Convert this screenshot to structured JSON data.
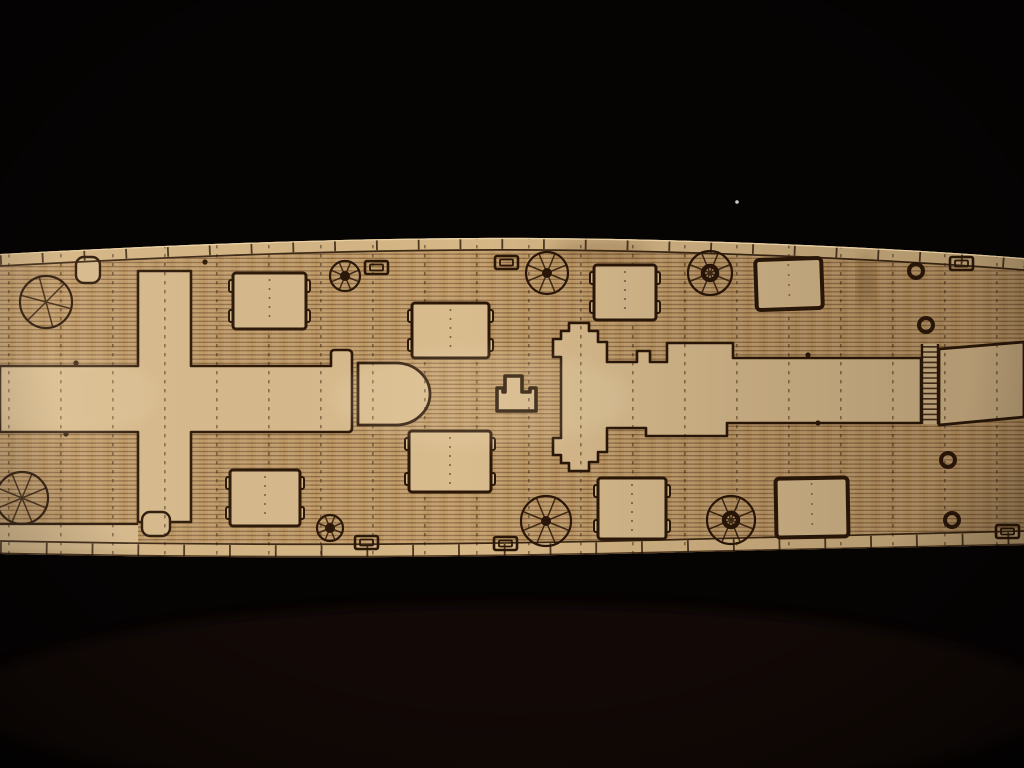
{
  "meta": {
    "description": "Photograph of a laser-etched wooden model ship deck strip lying diagonally across a black background, engraved with plank lines, hatches, capstan rosettes, rings and cleats"
  },
  "palette": {
    "bg": "#060303",
    "bg_glow": "#2c1410",
    "wood_planked": "#c49e6a",
    "wood_smooth": "#d9bc8e",
    "wood_margin": "#d6b786",
    "plank_line": "#5a3a1c",
    "outline": "#2a1708",
    "edge_highlight": "#eed7a8",
    "speck": "#e8e2d8"
  },
  "deck": {
    "hatches": [
      {
        "x": 233,
        "y": 273,
        "w": 73,
        "h": 56,
        "style": "notched",
        "tilt": 0
      },
      {
        "x": 412,
        "y": 303,
        "w": 77,
        "h": 55,
        "style": "notched",
        "tilt": 0
      },
      {
        "x": 409,
        "y": 431,
        "w": 82,
        "h": 61,
        "style": "notched",
        "tilt": 0
      },
      {
        "x": 230,
        "y": 470,
        "w": 70,
        "h": 56,
        "style": "notched",
        "tilt": 0
      },
      {
        "x": 594,
        "y": 265,
        "w": 62,
        "h": 55,
        "style": "notched",
        "tilt": 0
      },
      {
        "x": 598,
        "y": 478,
        "w": 68,
        "h": 61,
        "style": "notched",
        "tilt": 0
      },
      {
        "x": 756,
        "y": 259,
        "w": 66,
        "h": 50,
        "style": "plain",
        "tilt": -2
      },
      {
        "x": 776,
        "y": 478,
        "w": 72,
        "h": 59,
        "style": "plain",
        "tilt": -1
      }
    ],
    "rosettes": [
      {
        "cx": 46,
        "cy": 302,
        "r": 26,
        "spokes": 6,
        "hub": "none"
      },
      {
        "cx": 22,
        "cy": 498,
        "r": 26,
        "spokes": 8,
        "hub": "none"
      },
      {
        "cx": 345,
        "cy": 276,
        "r": 15,
        "spokes": 8,
        "hub": "dot"
      },
      {
        "cx": 547,
        "cy": 273,
        "r": 21,
        "spokes": 8,
        "hub": "dot"
      },
      {
        "cx": 710,
        "cy": 273,
        "r": 22,
        "spokes": 8,
        "hub": "ring"
      },
      {
        "cx": 330,
        "cy": 528,
        "r": 13,
        "spokes": 8,
        "hub": "dot"
      },
      {
        "cx": 546,
        "cy": 521,
        "r": 25,
        "spokes": 8,
        "hub": "dot"
      },
      {
        "cx": 731,
        "cy": 520,
        "r": 24,
        "spokes": 8,
        "hub": "ring"
      }
    ],
    "rings": [
      {
        "cx": 916,
        "cy": 271,
        "r": 7
      },
      {
        "cx": 926,
        "cy": 325,
        "r": 7
      },
      {
        "cx": 948,
        "cy": 460,
        "r": 7
      },
      {
        "cx": 952,
        "cy": 520,
        "r": 7
      }
    ],
    "cleats": [
      {
        "x": 365,
        "y": 261
      },
      {
        "x": 495,
        "y": 256
      },
      {
        "x": 950,
        "y": 257
      },
      {
        "x": 355,
        "y": 536
      },
      {
        "x": 494,
        "y": 537
      },
      {
        "x": 996,
        "y": 525
      }
    ],
    "dots": [
      {
        "cx": 76,
        "cy": 363
      },
      {
        "cx": 66,
        "cy": 434
      },
      {
        "cx": 205,
        "cy": 262
      },
      {
        "cx": 808,
        "cy": 355
      },
      {
        "cx": 818,
        "cy": 423
      }
    ],
    "speck": {
      "cx": 737,
      "cy": 202
    }
  }
}
